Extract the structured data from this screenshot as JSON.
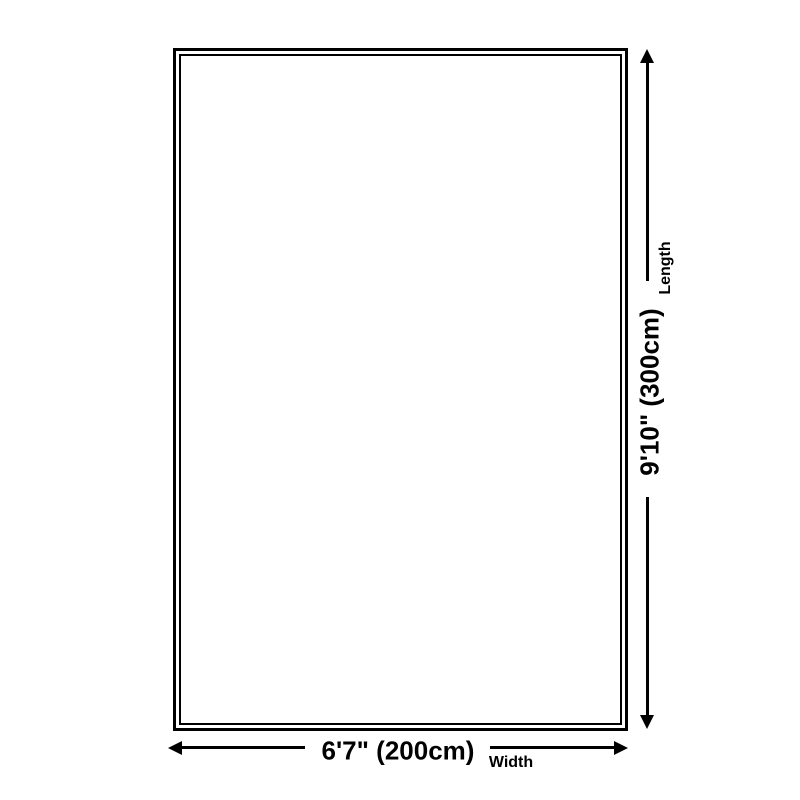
{
  "diagram": {
    "type": "product-dimension-diagram",
    "shape": "rectangle",
    "width": {
      "value": "6'7\" (200cm)",
      "label": "Width"
    },
    "length": {
      "value": "9'10\" (300cm)",
      "label": "Length"
    }
  },
  "colors": {
    "line": "#000000",
    "background": "#ffffff"
  }
}
